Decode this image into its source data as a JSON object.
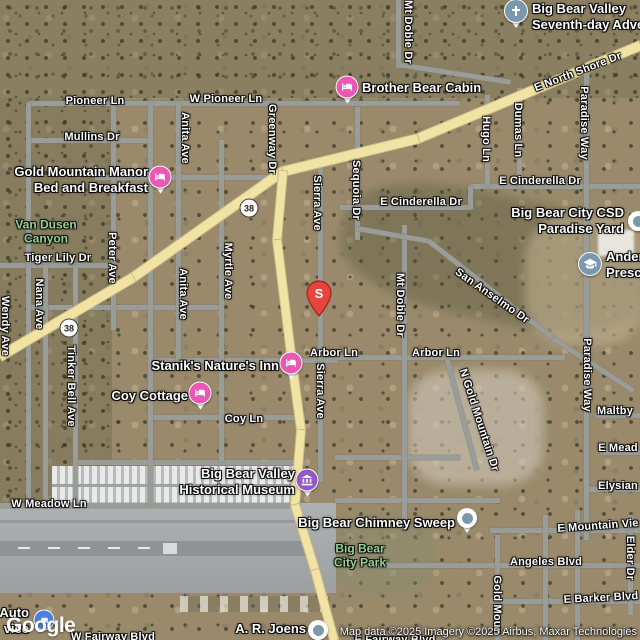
{
  "attribution": "Map data ©2025 Imagery ©2025 Airbus, Maxar Technologies",
  "google_logo": "Google",
  "marker": {
    "letter": "S"
  },
  "route_shields": [
    {
      "label": "38",
      "x": 249,
      "y": 208
    },
    {
      "label": "38",
      "x": 69,
      "y": 328
    }
  ],
  "street_labels": [
    {
      "text": "Pioneer Ln",
      "x": 95,
      "y": 101,
      "rot": 0
    },
    {
      "text": "W Pioneer Ln",
      "x": 226,
      "y": 99,
      "rot": 0
    },
    {
      "text": "Mullins Dr",
      "x": 92,
      "y": 137,
      "rot": 0
    },
    {
      "text": "Anita Ave",
      "x": 185,
      "y": 138,
      "rot": 90
    },
    {
      "text": "Greenway Dr",
      "x": 272,
      "y": 139,
      "rot": 90
    },
    {
      "text": "Mt Doble Dr",
      "x": 408,
      "y": 32,
      "rot": 90
    },
    {
      "text": "Sequoia Dr",
      "x": 356,
      "y": 190,
      "rot": 90
    },
    {
      "text": "Sierra Ave",
      "x": 317,
      "y": 203,
      "rot": 90
    },
    {
      "text": "Hugo Ln",
      "x": 486,
      "y": 139,
      "rot": 90
    },
    {
      "text": "Dumas Ln",
      "x": 518,
      "y": 130,
      "rot": 90
    },
    {
      "text": "Paradise Way",
      "x": 584,
      "y": 123,
      "rot": 90
    },
    {
      "text": "E North Shore Dr",
      "x": 578,
      "y": 72,
      "rot": -21
    },
    {
      "text": "E Cinderella Dr",
      "x": 540,
      "y": 181,
      "rot": 0
    },
    {
      "text": "E Cinderella Dr",
      "x": 421,
      "y": 202,
      "rot": 0
    },
    {
      "text": "Peter Ave",
      "x": 112,
      "y": 258,
      "rot": 90
    },
    {
      "text": "Tiger Lily Dr",
      "x": 58,
      "y": 258,
      "rot": 0
    },
    {
      "text": "Nana Ave",
      "x": 39,
      "y": 304,
      "rot": 90
    },
    {
      "text": "Wendy Ave",
      "x": 5,
      "y": 326,
      "rot": 90
    },
    {
      "text": "Anita Ave",
      "x": 183,
      "y": 294,
      "rot": 90
    },
    {
      "text": "Myrtle Ave",
      "x": 228,
      "y": 271,
      "rot": 90
    },
    {
      "text": "Sierra Ave",
      "x": 320,
      "y": 391,
      "rot": 90
    },
    {
      "text": "Mt Doble Dr",
      "x": 400,
      "y": 305,
      "rot": 90
    },
    {
      "text": "San Anselmo Dr",
      "x": 492,
      "y": 296,
      "rot": 35
    },
    {
      "text": "Arbor Ln",
      "x": 334,
      "y": 353,
      "rot": 0
    },
    {
      "text": "Arbor Ln",
      "x": 436,
      "y": 353,
      "rot": 0
    },
    {
      "text": "Coy Ln",
      "x": 244,
      "y": 419,
      "rot": 0
    },
    {
      "text": "Tinker Bell Ave",
      "x": 71,
      "y": 386,
      "rot": 90
    },
    {
      "text": "W Meadow Ln",
      "x": 49,
      "y": 504,
      "rot": 0
    },
    {
      "text": "W Fairway Blvd",
      "x": 113,
      "y": 637,
      "rot": 0
    },
    {
      "text": "E Fairway Blvd",
      "x": 395,
      "y": 640,
      "rot": 0
    },
    {
      "text": "Angeles Blvd",
      "x": 546,
      "y": 562,
      "rot": 0
    },
    {
      "text": "E Mountain Vie",
      "x": 598,
      "y": 526,
      "rot": -4
    },
    {
      "text": "E Barker Blvd",
      "x": 601,
      "y": 598,
      "rot": -3
    },
    {
      "text": "Gold Moun",
      "x": 497,
      "y": 605,
      "rot": 90
    },
    {
      "text": "Elder Dr",
      "x": 630,
      "y": 558,
      "rot": 90
    },
    {
      "text": "Elysian",
      "x": 618,
      "y": 486,
      "rot": 0
    },
    {
      "text": "E Mead",
      "x": 618,
      "y": 448,
      "rot": 0
    },
    {
      "text": "Maltby",
      "x": 615,
      "y": 411,
      "rot": 0
    },
    {
      "text": "N Gold Mountain Dr",
      "x": 479,
      "y": 420,
      "rot": 72
    },
    {
      "text": "Paradise Way",
      "x": 587,
      "y": 375,
      "rot": 90
    }
  ],
  "park_labels": [
    {
      "lines": [
        "Van Dusen",
        "Canyon"
      ],
      "x": 46,
      "y": 232
    },
    {
      "lines": [
        "Big Bear",
        "City Park"
      ],
      "x": 360,
      "y": 556
    }
  ],
  "places": [
    {
      "lines": [
        "Brother Bear Cabin"
      ],
      "icon": "lodging-icon",
      "ix": 347,
      "iy": 87,
      "side": "right",
      "lx": 362,
      "ly": 88
    },
    {
      "lines": [
        "Gold Mountain Manor",
        "Bed and Breakfast"
      ],
      "icon": "lodging-icon",
      "ix": 160,
      "iy": 177,
      "side": "left",
      "lx": 148,
      "ly": 180
    },
    {
      "lines": [
        "Stanik's Nature's Inn"
      ],
      "icon": "lodging-icon",
      "ix": 291,
      "iy": 363,
      "side": "left",
      "lx": 279,
      "ly": 366
    },
    {
      "lines": [
        "Coy Cottage"
      ],
      "icon": "lodging-icon",
      "ix": 200,
      "iy": 393,
      "side": "left",
      "lx": 188,
      "ly": 396
    },
    {
      "lines": [
        "Big Bear Valley",
        "Historical Museum"
      ],
      "icon": "museum-icon",
      "ix": 307,
      "iy": 480,
      "side": "left",
      "lx": 295,
      "ly": 482
    },
    {
      "lines": [
        "Big Bear Chimney Sweep"
      ],
      "icon": "pin-dot-icon",
      "ix": 467,
      "iy": 518,
      "side": "left",
      "lx": 455,
      "ly": 523
    },
    {
      "lines": [
        "Big Bear Valley",
        "Seventh-day Adve"
      ],
      "icon": "church-pin-icon",
      "ix": 516,
      "iy": 11,
      "side": "right",
      "lx": 532,
      "ly": 17
    },
    {
      "lines": [
        "Big Bear City CSD",
        "Paradise Yard"
      ],
      "icon": "dot-icon",
      "ix": 638,
      "iy": 221,
      "side": "left",
      "lx": 624,
      "ly": 221
    },
    {
      "lines": [
        "Ander",
        "Presc"
      ],
      "icon": "school-icon",
      "ix": 590,
      "iy": 264,
      "side": "right",
      "lx": 606,
      "ly": 265
    },
    {
      "lines": [
        "A. R. Joens"
      ],
      "icon": "dot-icon",
      "ix": 318,
      "iy": 630,
      "side": "left",
      "lx": 306,
      "ly": 629
    },
    {
      "lines": [
        "Auto",
        "vice"
      ],
      "icon": "auto-icon",
      "ix": 44,
      "iy": 620,
      "side": "left",
      "lx": 29,
      "ly": 621
    }
  ],
  "colors": {
    "lodging_pink": "#e958b2",
    "museum_purple": "#9257c9",
    "poi_slate": "#7b99ab",
    "auto_blue": "#4e7fd9",
    "marker_red": "#e7453c",
    "road_yellow": "#f0e3a4",
    "road_gray": "#9a9c98",
    "park_green": "#96d492"
  }
}
